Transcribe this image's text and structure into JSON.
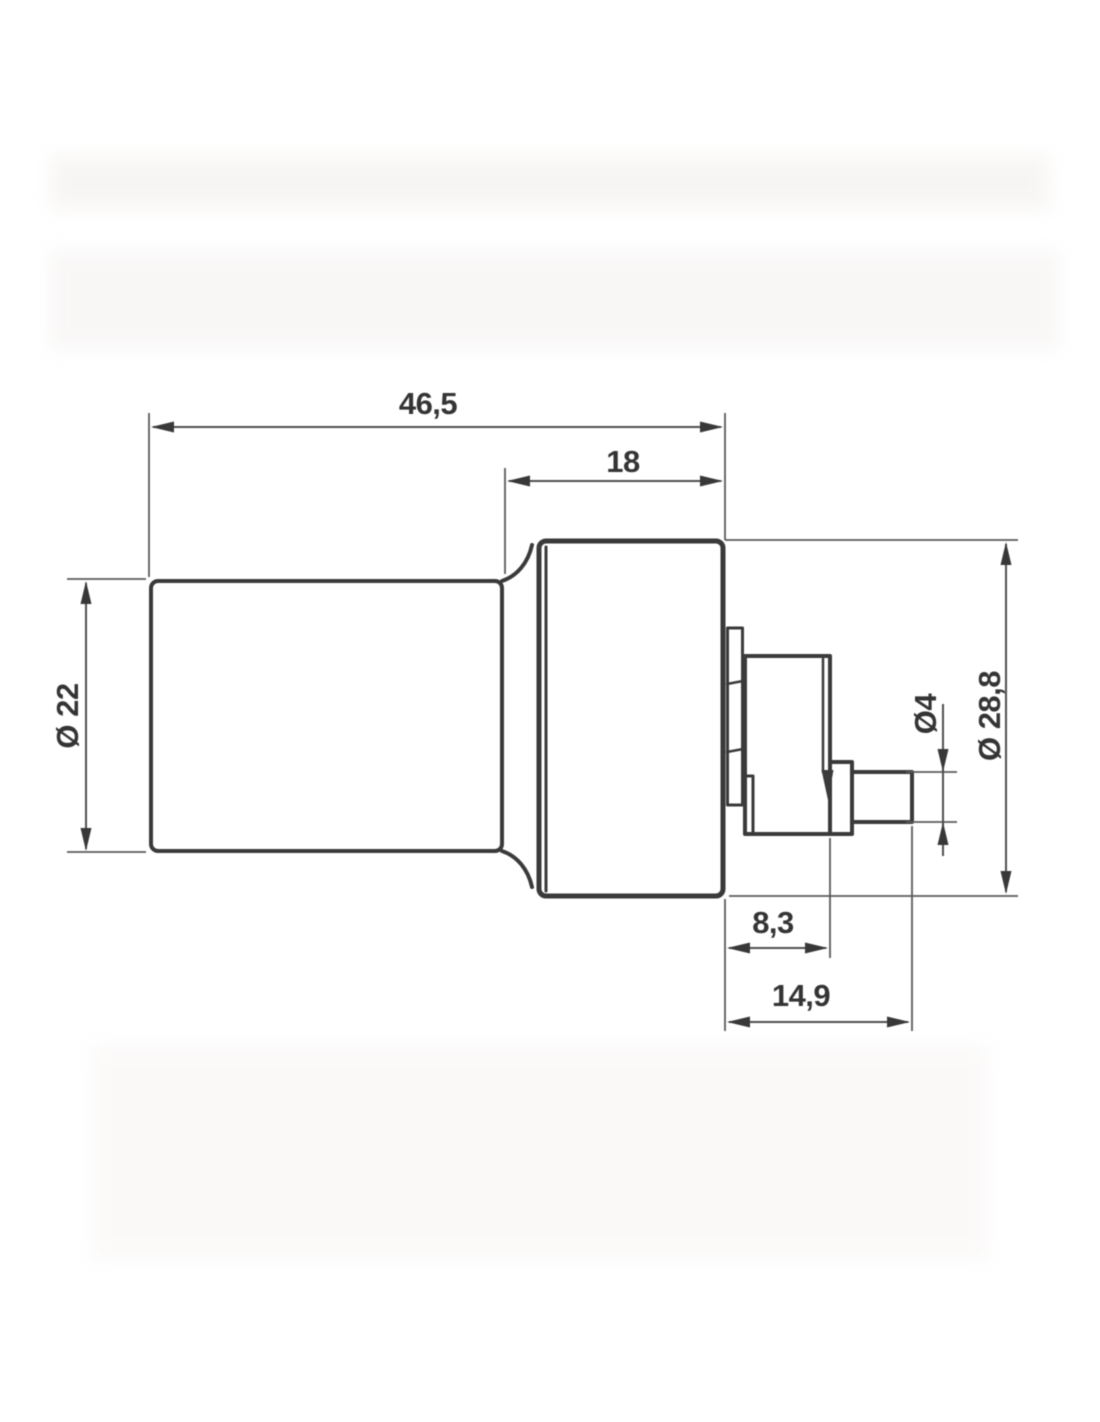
{
  "drawing": {
    "type": "technical-dimension-drawing",
    "subject": "cylindrical body with stepped output shaft, side view",
    "units_style": "decimal-comma",
    "dimensions": {
      "overall_length": "46,5",
      "head_length": "18",
      "body_diameter": "Ø 22",
      "head_diameter": "Ø 28,8",
      "shaft_diameter": "Ø4",
      "hub_length": "8,3",
      "shaft_total_length": "14,9"
    },
    "colors": {
      "outline": "#3a3a3a",
      "dimension_line": "#4f4f4f",
      "extension_line": "#5a5a5a",
      "text": "#343434",
      "background": "#ffffff"
    }
  }
}
